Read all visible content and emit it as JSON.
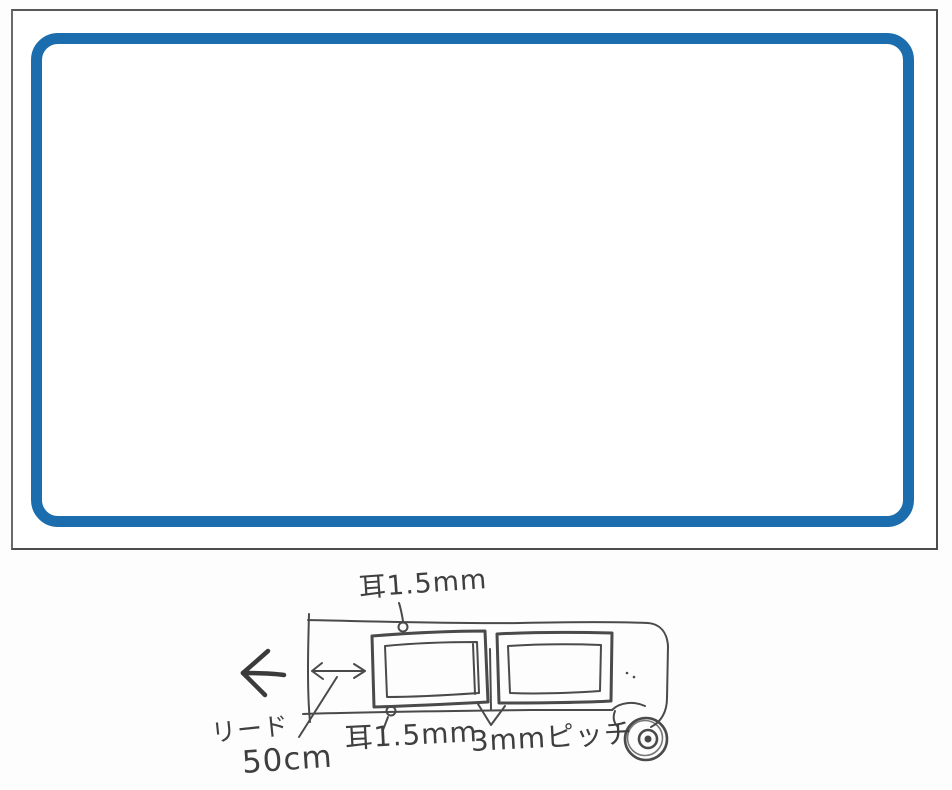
{
  "page": {
    "background_color": "#fdfdfd"
  },
  "label_card": {
    "outline_color": "#4c4c4c",
    "border_color": "#1c6dad",
    "fill_color": "#ffffff"
  },
  "sketch": {
    "ink_color": "#454545",
    "annotations": {
      "top_margin_label": "耳1.5mm",
      "bottom_margin_label": "耳1.5mm",
      "pitch_label": "3mmピッチ",
      "lead_label": "リード",
      "lead_length_label": "50cm"
    },
    "icons": {
      "feed_direction": "left-arrow-icon",
      "lead_dimension": "double-headed-arrow-icon",
      "pitch_pointer": "down-v-arrow-icon",
      "roll_end": "rolled-tape-icon"
    }
  }
}
